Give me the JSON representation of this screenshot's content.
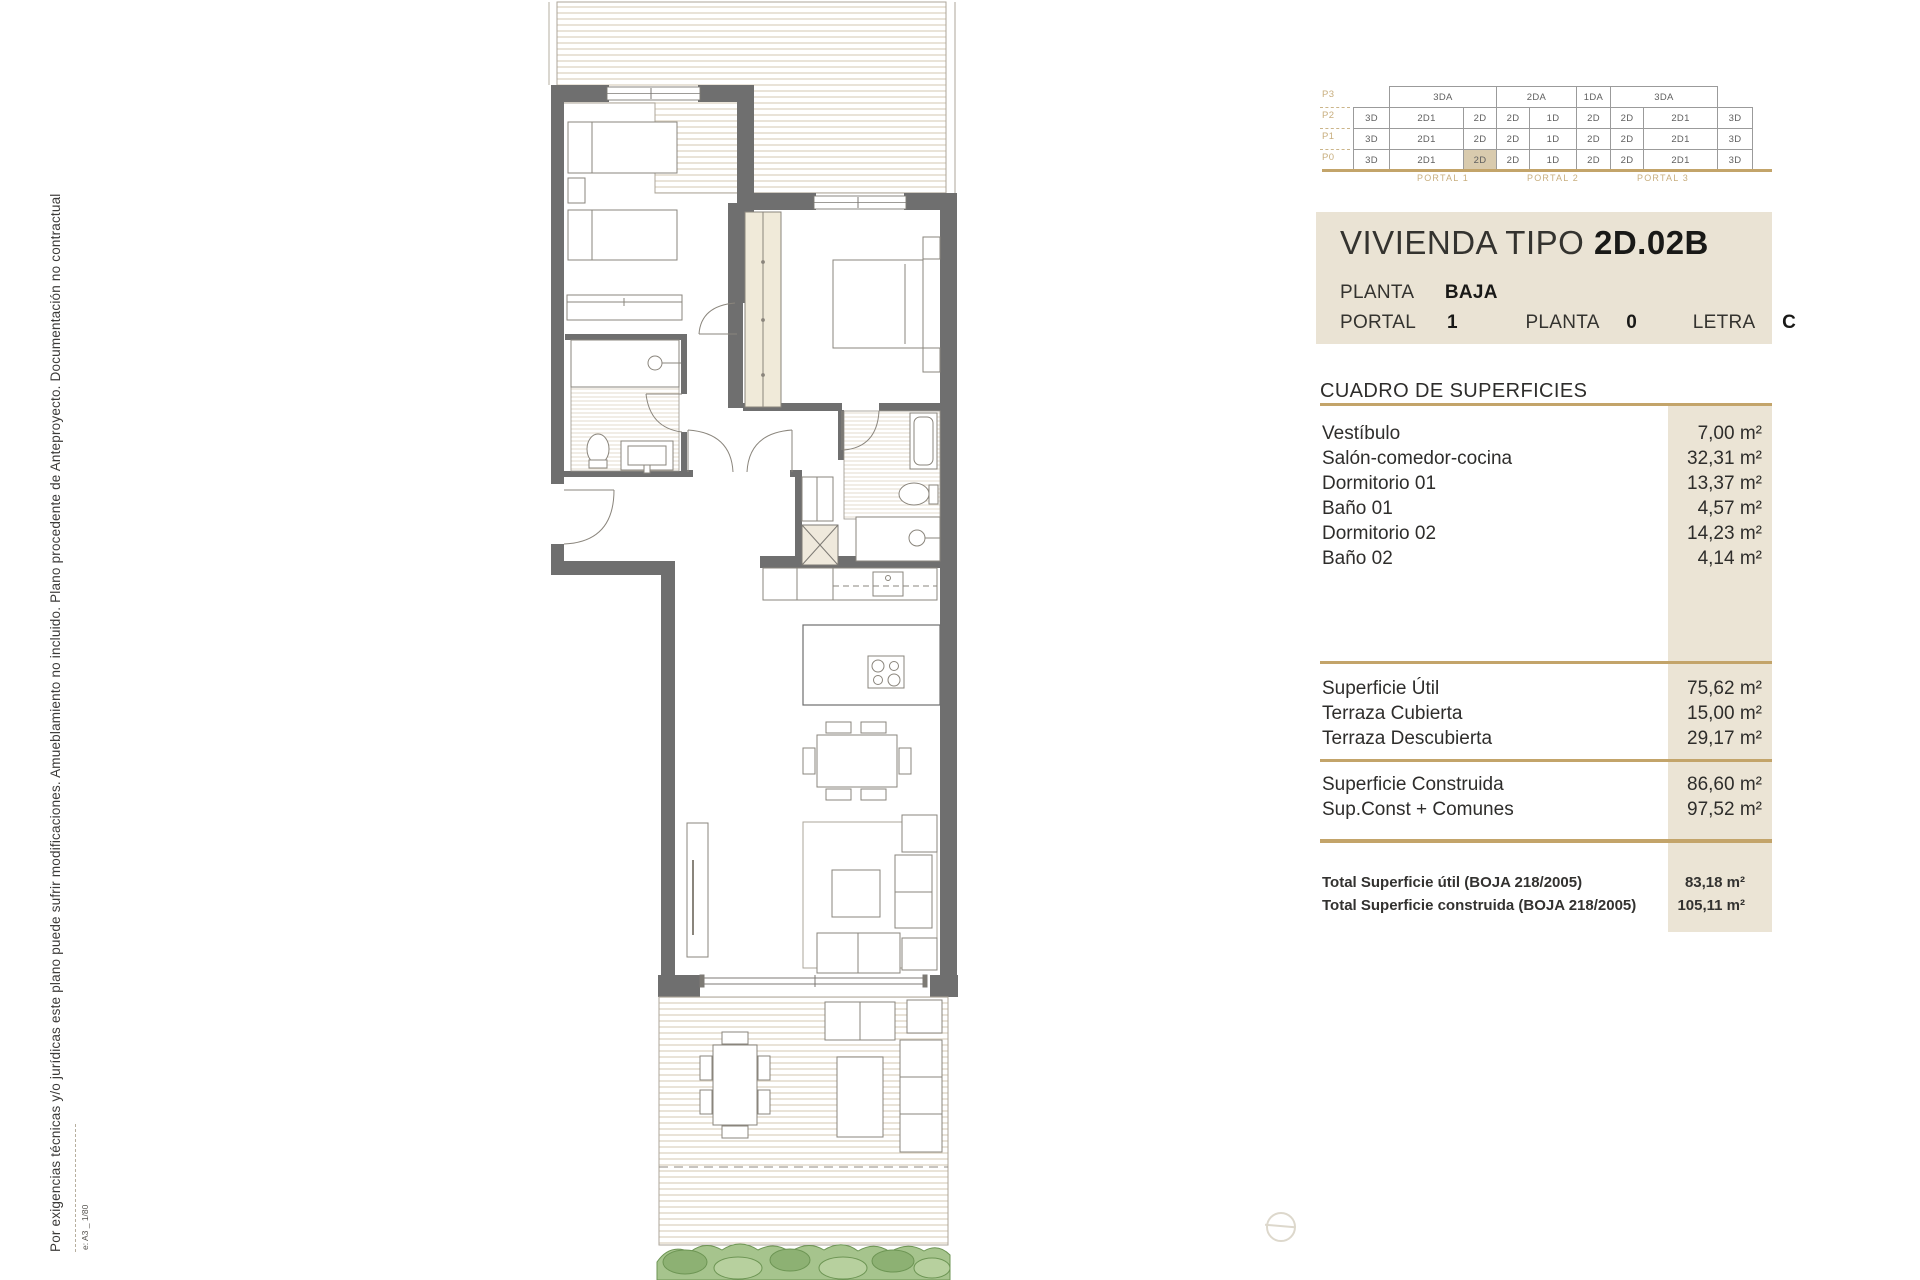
{
  "side_note": {
    "text": "Por exigencias técnicas y/o jurídicas este plano puede sufrir modificaciones. Amueblamiento no incluido. Plano procedente de Anteproyecto. Documentación no contractual",
    "scale_note": "e: A3 _ 1/80"
  },
  "building_matrix": {
    "floors": [
      "P3",
      "P2",
      "P1",
      "P0"
    ],
    "p3": [
      "3DA",
      "2DA",
      "1DA",
      "3DA"
    ],
    "p2": [
      "3D",
      "2D1",
      "2D",
      "2D",
      "1D",
      "2D",
      "2D",
      "2D1",
      "3D"
    ],
    "p1": [
      "3D",
      "2D1",
      "2D",
      "2D",
      "1D",
      "2D",
      "2D",
      "2D1",
      "3D"
    ],
    "p0": [
      "3D",
      "2D1",
      "2D",
      "2D",
      "1D",
      "2D",
      "2D",
      "2D1",
      "3D"
    ],
    "portals": [
      "PORTAL 1",
      "PORTAL 2",
      "PORTAL 3"
    ],
    "highlighted_cell": "P0 / 2D (col 3)"
  },
  "title_block": {
    "name": "VIVIENDA TIPO",
    "code": "2D.02B",
    "planta_label": "PLANTA",
    "planta_value": "BAJA",
    "portal_label": "PORTAL",
    "portal_value": "1",
    "planta2_label": "PLANTA",
    "planta2_value": "0",
    "letra_label": "LETRA",
    "letra_value": "C"
  },
  "surfaces": {
    "header": "CUADRO DE SUPERFICIES",
    "rooms": [
      {
        "name": "Vestíbulo",
        "area": "7,00 m²"
      },
      {
        "name": "Salón-comedor-cocina",
        "area": "32,31 m²"
      },
      {
        "name": "Dormitorio 01",
        "area": "13,37 m²"
      },
      {
        "name": "Baño 01",
        "area": "4,57 m²"
      },
      {
        "name": "Dormitorio 02",
        "area": "14,23 m²"
      },
      {
        "name": "Baño 02",
        "area": "4,14 m²"
      }
    ],
    "subtotals": [
      {
        "name": "Superficie Útil",
        "area": "75,62 m²"
      },
      {
        "name": "Terraza Cubierta",
        "area": "15,00 m²"
      },
      {
        "name": "Terraza Descubierta",
        "area": "29,17 m²"
      }
    ],
    "construida": [
      {
        "name": "Superficie Construida",
        "area": "86,60 m²"
      },
      {
        "name": "Sup.Const + Comunes",
        "area": "97,52 m²"
      }
    ],
    "totals": [
      {
        "name": "Total Superficie útil (BOJA 218/2005)",
        "area": "83,18 m²"
      },
      {
        "name": "Total Superficie construida (BOJA 218/2005)",
        "area": "105,11 m²"
      }
    ]
  },
  "colors": {
    "gold": "#c3a46a",
    "beige_panel": "#eae3d4",
    "beige_strip": "#ebe4d5",
    "highlight_cell": "#d9cbae",
    "wall_gray": "#6f6f6f",
    "hatch_line": "#e2dacb",
    "hedge_green": "#a6c48d",
    "tan_label": "#c8ae7e"
  }
}
